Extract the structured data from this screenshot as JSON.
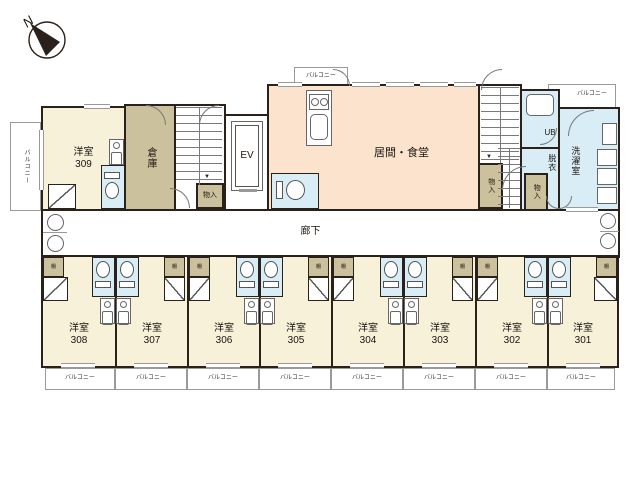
{
  "palette": {
    "wall": "#2b211b",
    "cream": "#f6f1d8",
    "tan": "#cbc19c",
    "peach": "#fbe3cd",
    "blue": "#d9edf6",
    "line": "#8a8a8a",
    "text": "#1c1410",
    "white": "#ffffff"
  },
  "compass": {
    "label": "N"
  },
  "shelf_label": "棚",
  "balconies": [
    {
      "id": "balcony-left",
      "label": "バルコニー",
      "x": 10,
      "y": 122,
      "w": 31,
      "h": 89,
      "vertical": true,
      "fs": 6
    },
    {
      "id": "balcony-top-center",
      "label": "バルコニー",
      "x": 294,
      "y": 67,
      "w": 54,
      "h": 20,
      "fs": 6
    },
    {
      "id": "balcony-top-right",
      "label": "バルコニー",
      "x": 548,
      "y": 84,
      "w": 68,
      "h": 25,
      "fs": 6,
      "dx": 10,
      "dy": -2
    },
    {
      "id": "balcony-308",
      "label": "バルコニー",
      "x": 45,
      "y": 368,
      "w": 70,
      "h": 22,
      "fs": 6
    },
    {
      "id": "balcony-307",
      "label": "バルコニー",
      "x": 115,
      "y": 368,
      "w": 72,
      "h": 22,
      "fs": 6
    },
    {
      "id": "balcony-306",
      "label": "バルコニー",
      "x": 187,
      "y": 368,
      "w": 72,
      "h": 22,
      "fs": 6
    },
    {
      "id": "balcony-305",
      "label": "バルコニー",
      "x": 259,
      "y": 368,
      "w": 72,
      "h": 22,
      "fs": 6
    },
    {
      "id": "balcony-304",
      "label": "バルコニー",
      "x": 331,
      "y": 368,
      "w": 72,
      "h": 22,
      "fs": 6
    },
    {
      "id": "balcony-303",
      "label": "バルコニー",
      "x": 403,
      "y": 368,
      "w": 72,
      "h": 22,
      "fs": 6
    },
    {
      "id": "balcony-302",
      "label": "バルコニー",
      "x": 475,
      "y": 368,
      "w": 72,
      "h": 22,
      "fs": 6
    },
    {
      "id": "balcony-301",
      "label": "バルコニー",
      "x": 547,
      "y": 368,
      "w": 68,
      "h": 22,
      "fs": 6
    }
  ],
  "regions": [
    {
      "id": "room-309",
      "label": "洋室",
      "sub": "309",
      "x": 41,
      "y": 106,
      "w": 85,
      "h": 105,
      "fill": "cream",
      "fs": 10
    },
    {
      "id": "storage",
      "label": "倉庫",
      "x": 124,
      "y": 104,
      "w": 52,
      "h": 107,
      "fill": "tan",
      "fs": 10,
      "vertical": true
    },
    {
      "id": "stairwell-1",
      "x": 174,
      "y": 104,
      "w": 52,
      "h": 107,
      "fill": "white"
    },
    {
      "id": "elevator-hall",
      "x": 224,
      "y": 114,
      "w": 45,
      "h": 97,
      "fill": "white"
    },
    {
      "id": "living-dining",
      "label": "居間・食堂",
      "x": 267,
      "y": 84,
      "w": 213,
      "h": 127,
      "fill": "peach",
      "fs": 11,
      "dx": 28,
      "dy": 6
    },
    {
      "id": "stairwell-2",
      "x": 478,
      "y": 84,
      "w": 44,
      "h": 127,
      "fill": "white"
    },
    {
      "id": "unit-bath",
      "label": "UB",
      "x": 520,
      "y": 89,
      "w": 40,
      "h": 60,
      "fill": "blue",
      "fs": 8,
      "dx": 10,
      "dy": 14
    },
    {
      "id": "dressing-room",
      "label": "脱衣",
      "x": 520,
      "y": 147,
      "w": 40,
      "h": 64,
      "fill": "blue",
      "fs": 8,
      "vertical": true,
      "dx": 12,
      "dy": -16
    },
    {
      "id": "laundry-room",
      "label": "洗濯室",
      "x": 558,
      "y": 107,
      "w": 62,
      "h": 104,
      "fill": "blue",
      "fs": 9,
      "vertical": true,
      "dx": -14,
      "dy": 2
    },
    {
      "id": "corridor",
      "label": "廊下",
      "x": 41,
      "y": 209,
      "w": 579,
      "h": 49,
      "fill": "white",
      "fs": 10,
      "dx": -20,
      "dy": -2
    },
    {
      "id": "room-308",
      "label": "洋室",
      "sub": "308",
      "x": 41,
      "y": 255,
      "w": 76,
      "h": 113,
      "fill": "cream",
      "fs": 10,
      "dy": 23
    },
    {
      "id": "room-307",
      "label": "洋室",
      "sub": "307",
      "x": 115,
      "y": 255,
      "w": 74,
      "h": 113,
      "fill": "cream",
      "fs": 10,
      "dy": 23
    },
    {
      "id": "room-306",
      "label": "洋室",
      "sub": "306",
      "x": 187,
      "y": 255,
      "w": 74,
      "h": 113,
      "fill": "cream",
      "fs": 10,
      "dy": 23
    },
    {
      "id": "room-305",
      "label": "洋室",
      "sub": "305",
      "x": 259,
      "y": 255,
      "w": 74,
      "h": 113,
      "fill": "cream",
      "fs": 10,
      "dy": 23
    },
    {
      "id": "room-304",
      "label": "洋室",
      "sub": "304",
      "x": 331,
      "y": 255,
      "w": 74,
      "h": 113,
      "fill": "cream",
      "fs": 10,
      "dy": 23
    },
    {
      "id": "room-303",
      "label": "洋室",
      "sub": "303",
      "x": 403,
      "y": 255,
      "w": 74,
      "h": 113,
      "fill": "cream",
      "fs": 10,
      "dy": 23
    },
    {
      "id": "room-302",
      "label": "洋室",
      "sub": "302",
      "x": 475,
      "y": 255,
      "w": 74,
      "h": 113,
      "fill": "cream",
      "fs": 10,
      "dy": 23
    },
    {
      "id": "room-301",
      "label": "洋室",
      "sub": "301",
      "x": 547,
      "y": 255,
      "w": 72,
      "h": 113,
      "fill": "cream",
      "fs": 10,
      "dy": 23
    },
    {
      "id": "closet-stair1",
      "label": "物入",
      "x": 196,
      "y": 183,
      "w": 28,
      "h": 26,
      "fill": "tan",
      "fs": 7
    },
    {
      "id": "closet-stair2",
      "label": "物入",
      "x": 478,
      "y": 163,
      "w": 25,
      "h": 46,
      "fill": "tan",
      "fs": 7,
      "vertical": true
    },
    {
      "id": "closet-right",
      "label": "物入",
      "x": 524,
      "y": 173,
      "w": 24,
      "h": 38,
      "fill": "tan",
      "fs": 7,
      "vertical": true
    }
  ],
  "stairs": [
    {
      "id": "stair1-treads",
      "x": 176,
      "y": 107,
      "w": 46,
      "h": 78
    },
    {
      "id": "stair2-treads",
      "x": 481,
      "y": 87,
      "w": 38,
      "h": 76
    },
    {
      "id": "stair2-lower-treads",
      "x": 498,
      "y": 148,
      "w": 22,
      "h": 60
    }
  ],
  "fixtures": [
    {
      "id": "elevator-car",
      "type": "box",
      "label": "EV",
      "x": 231,
      "y": 121,
      "w": 32,
      "h": 70,
      "fs": 10,
      "double": true
    },
    {
      "id": "elevator-door",
      "type": "hline",
      "x": 239,
      "y": 189,
      "w": 18,
      "h": 3
    },
    {
      "id": "kitchen-counter",
      "type": "box",
      "x": 306,
      "y": 90,
      "w": 26,
      "h": 56
    },
    {
      "id": "kitchen-stove",
      "type": "stove",
      "x": 309,
      "y": 94,
      "w": 20,
      "h": 16
    },
    {
      "id": "kitchen-sink",
      "type": "rounded",
      "x": 310,
      "y": 114,
      "w": 18,
      "h": 26
    },
    {
      "id": "bath-tub",
      "type": "rounded",
      "x": 526,
      "y": 94,
      "w": 28,
      "h": 22
    },
    {
      "id": "washer-1",
      "type": "box",
      "x": 597,
      "y": 149,
      "w": 20,
      "h": 17
    },
    {
      "id": "washer-2",
      "type": "box",
      "x": 597,
      "y": 168,
      "w": 20,
      "h": 17
    },
    {
      "id": "washer-3",
      "type": "box",
      "x": 597,
      "y": 187,
      "w": 20,
      "h": 17
    },
    {
      "id": "laundry-appliance",
      "type": "box",
      "x": 602,
      "y": 123,
      "w": 15,
      "h": 22
    },
    {
      "id": "sink-divider-left",
      "type": "hline",
      "x": 43,
      "y": 232,
      "w": 24,
      "h": 1
    },
    {
      "id": "sink-divider-right",
      "type": "hline",
      "x": 600,
      "y": 231,
      "w": 19,
      "h": 1
    }
  ],
  "kitchenettes": [
    {
      "id": "kitchenette-309",
      "x": 109,
      "y": 139
    },
    {
      "id": "kitchenette-308",
      "x": 100,
      "y": 298
    },
    {
      "id": "kitchenette-307",
      "x": 116,
      "y": 298
    },
    {
      "id": "kitchenette-306",
      "x": 244,
      "y": 298
    },
    {
      "id": "kitchenette-305",
      "x": 260,
      "y": 298
    },
    {
      "id": "kitchenette-304",
      "x": 388,
      "y": 298
    },
    {
      "id": "kitchenette-303",
      "x": 404,
      "y": 298
    },
    {
      "id": "kitchenette-302",
      "x": 532,
      "y": 298
    },
    {
      "id": "kitchenette-301",
      "x": 548,
      "y": 298
    }
  ],
  "toilets": [
    {
      "id": "toilet-309",
      "x": 101,
      "y": 165,
      "w": 24,
      "h": 44,
      "dir": "up"
    },
    {
      "id": "toilet-main",
      "x": 271,
      "y": 173,
      "w": 48,
      "h": 36,
      "dir": "right"
    },
    {
      "id": "toilet-308",
      "x": 92,
      "y": 257,
      "w": 23,
      "h": 40,
      "dir": "down"
    },
    {
      "id": "toilet-307",
      "x": 116,
      "y": 257,
      "w": 23,
      "h": 40,
      "dir": "down"
    },
    {
      "id": "toilet-306",
      "x": 236,
      "y": 257,
      "w": 23,
      "h": 40,
      "dir": "down"
    },
    {
      "id": "toilet-305",
      "x": 260,
      "y": 257,
      "w": 23,
      "h": 40,
      "dir": "down"
    },
    {
      "id": "toilet-304",
      "x": 380,
      "y": 257,
      "w": 23,
      "h": 40,
      "dir": "down"
    },
    {
      "id": "toilet-303",
      "x": 404,
      "y": 257,
      "w": 23,
      "h": 40,
      "dir": "down"
    },
    {
      "id": "toilet-302",
      "x": 524,
      "y": 257,
      "w": 23,
      "h": 40,
      "dir": "down"
    },
    {
      "id": "toilet-301",
      "x": 548,
      "y": 257,
      "w": 23,
      "h": 40,
      "dir": "down"
    }
  ],
  "shelves": [
    {
      "id": "shelf-308",
      "label": "棚",
      "x": 43,
      "y": 257,
      "w": 21,
      "h": 20
    },
    {
      "id": "shelf-307",
      "label": "棚",
      "x": 164,
      "y": 257,
      "w": 21,
      "h": 20
    },
    {
      "id": "shelf-306",
      "label": "棚",
      "x": 189,
      "y": 257,
      "w": 21,
      "h": 20
    },
    {
      "id": "shelf-305",
      "label": "棚",
      "x": 308,
      "y": 257,
      "w": 21,
      "h": 20
    },
    {
      "id": "shelf-304",
      "label": "棚",
      "x": 333,
      "y": 257,
      "w": 21,
      "h": 20
    },
    {
      "id": "shelf-303",
      "label": "棚",
      "x": 452,
      "y": 257,
      "w": 21,
      "h": 20
    },
    {
      "id": "shelf-302",
      "label": "棚",
      "x": 477,
      "y": 257,
      "w": 21,
      "h": 20
    },
    {
      "id": "shelf-301",
      "label": "棚",
      "x": 596,
      "y": 257,
      "w": 21,
      "h": 20
    }
  ],
  "closet_doors": [
    {
      "id": "closetdoor-309",
      "x": 48,
      "y": 184,
      "w": 28,
      "h": 25,
      "d": "r"
    },
    {
      "id": "closetdoor-308",
      "x": 43,
      "y": 277,
      "w": 25,
      "h": 24,
      "d": "r"
    },
    {
      "id": "closetdoor-307",
      "x": 164,
      "y": 277,
      "w": 21,
      "h": 24,
      "d": "l"
    },
    {
      "id": "closetdoor-306",
      "x": 189,
      "y": 277,
      "w": 21,
      "h": 24,
      "d": "r"
    },
    {
      "id": "closetdoor-305",
      "x": 308,
      "y": 277,
      "w": 21,
      "h": 24,
      "d": "l"
    },
    {
      "id": "closetdoor-304",
      "x": 333,
      "y": 277,
      "w": 21,
      "h": 24,
      "d": "r"
    },
    {
      "id": "closetdoor-303",
      "x": 452,
      "y": 277,
      "w": 21,
      "h": 24,
      "d": "l"
    },
    {
      "id": "closetdoor-302",
      "x": 477,
      "y": 277,
      "w": 21,
      "h": 24,
      "d": "r"
    },
    {
      "id": "closetdoor-301",
      "x": 594,
      "y": 277,
      "w": 23,
      "h": 24,
      "d": "l"
    }
  ],
  "arcs": [
    {
      "id": "door-storage-top",
      "x": 146,
      "y": 105,
      "w": 20,
      "h": 20,
      "c": "tr"
    },
    {
      "id": "door-stair1-top",
      "x": 199,
      "y": 105,
      "w": 20,
      "h": 20,
      "c": "tl"
    },
    {
      "id": "door-balcony-center",
      "x": 333,
      "y": 69,
      "w": 17,
      "h": 17,
      "c": "tr"
    },
    {
      "id": "door-stair2-top",
      "x": 481,
      "y": 69,
      "w": 21,
      "h": 21,
      "c": "tl"
    },
    {
      "id": "door-laundry",
      "x": 568,
      "y": 110,
      "w": 26,
      "h": 26,
      "c": "tl"
    },
    {
      "id": "door-unit-bath",
      "x": 540,
      "y": 128,
      "w": 17,
      "h": 17,
      "c": "br"
    },
    {
      "id": "door-corridor-stair1",
      "x": 170,
      "y": 188,
      "w": 20,
      "h": 20,
      "c": "tr"
    },
    {
      "id": "door-living-east",
      "x": 502,
      "y": 166,
      "w": 24,
      "h": 24,
      "c": "tl"
    },
    {
      "id": "door-dressing-1",
      "x": 546,
      "y": 196,
      "w": 13,
      "h": 13,
      "c": "bl"
    },
    {
      "id": "door-dressing-2",
      "x": 559,
      "y": 196,
      "w": 13,
      "h": 13,
      "c": "br"
    }
  ],
  "windows": [
    {
      "x": 278,
      "y": 82,
      "w": 24,
      "h": 5
    },
    {
      "x": 352,
      "y": 82,
      "w": 28,
      "h": 5
    },
    {
      "x": 386,
      "y": 82,
      "w": 28,
      "h": 5
    },
    {
      "x": 420,
      "y": 82,
      "w": 28,
      "h": 5
    },
    {
      "x": 454,
      "y": 82,
      "w": 22,
      "h": 5
    },
    {
      "x": 84,
      "y": 104,
      "w": 26,
      "h": 5
    },
    {
      "x": 61,
      "y": 363,
      "w": 34,
      "h": 5
    },
    {
      "x": 134,
      "y": 363,
      "w": 34,
      "h": 5
    },
    {
      "x": 206,
      "y": 363,
      "w": 34,
      "h": 5
    },
    {
      "x": 278,
      "y": 363,
      "w": 34,
      "h": 5
    },
    {
      "x": 350,
      "y": 363,
      "w": 34,
      "h": 5
    },
    {
      "x": 422,
      "y": 363,
      "w": 34,
      "h": 5
    },
    {
      "x": 494,
      "y": 363,
      "w": 34,
      "h": 5
    },
    {
      "x": 566,
      "y": 363,
      "w": 34,
      "h": 5
    },
    {
      "x": 566,
      "y": 207,
      "w": 32,
      "h": 5
    },
    {
      "x": 39,
      "y": 130,
      "w": 5,
      "h": 60,
      "v": true
    }
  ],
  "sinks": [
    {
      "id": "corridor-sink-left-1",
      "x": 47,
      "y": 214,
      "d": 17
    },
    {
      "id": "corridor-sink-left-2",
      "x": 47,
      "y": 235,
      "d": 17
    },
    {
      "id": "corridor-sink-right-1",
      "x": 600,
      "y": 213,
      "d": 16
    },
    {
      "id": "corridor-sink-right-2",
      "x": 600,
      "y": 233,
      "d": 16
    }
  ],
  "arrows": [
    {
      "id": "stair1-arrow",
      "ch": "▼",
      "x": 204,
      "y": 174
    },
    {
      "id": "stair2-arrow",
      "ch": "▼",
      "x": 486,
      "y": 154
    }
  ]
}
